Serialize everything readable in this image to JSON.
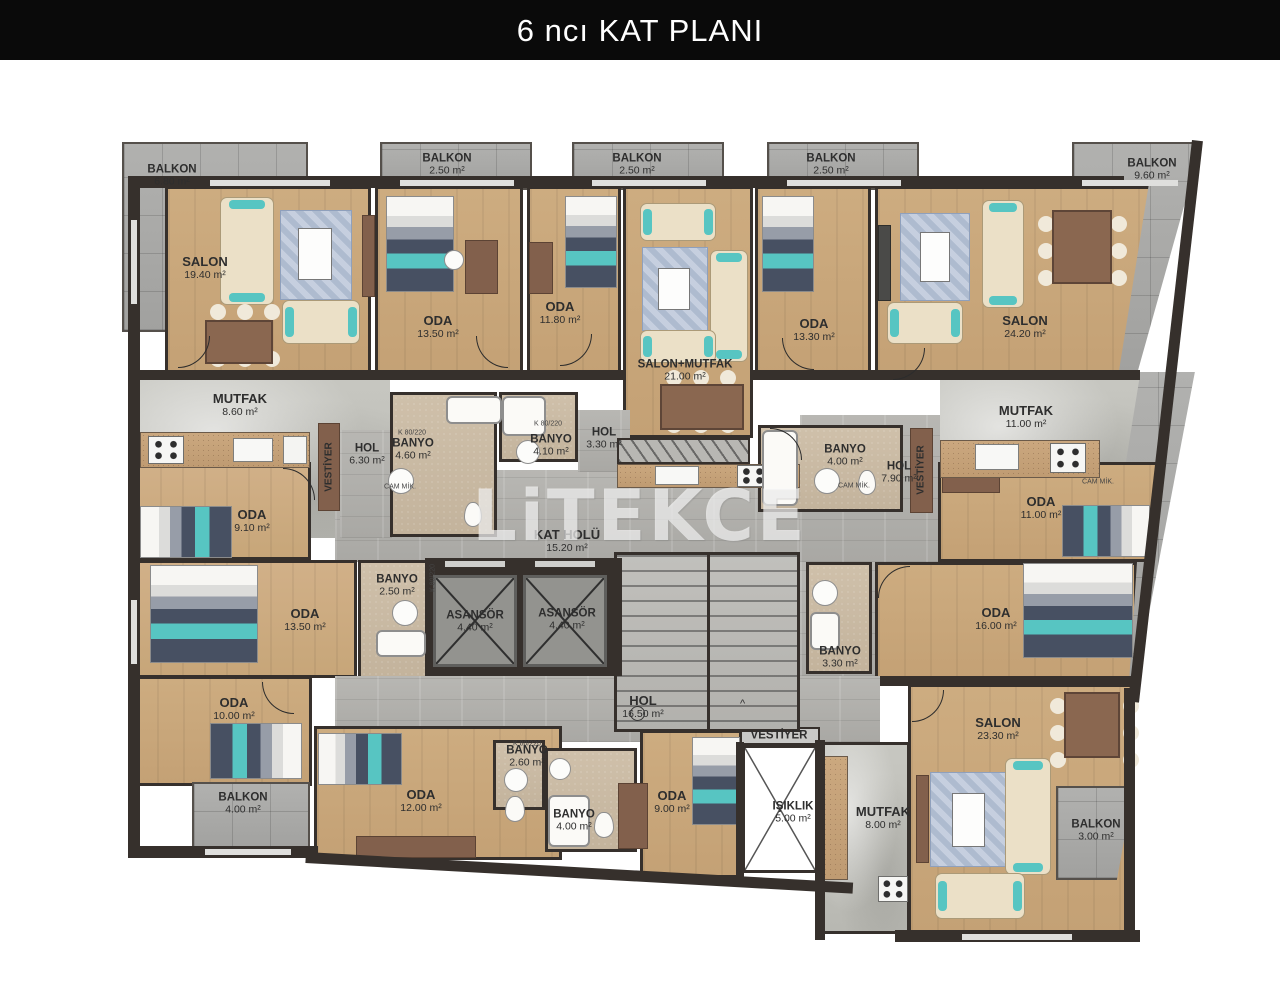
{
  "title": "6 ncı KAT PLANI",
  "watermark": "LiTEKCE",
  "tags": {
    "door": "K 80/220",
    "glass": "CAM MİK."
  },
  "colors": {
    "wall": "#36302c",
    "wood": "#c9a87c",
    "tile": "#ababa8",
    "bath": "#cdbda7",
    "teal": "#57c5c2",
    "title_bg": "#0a0a0a"
  },
  "rooms": {
    "balkon_tl": {
      "name": "BALKON",
      "area": "6.80 m²"
    },
    "balkon_t1": {
      "name": "BALKON",
      "area": "2.50 m²"
    },
    "balkon_t2": {
      "name": "BALKON",
      "area": "2.50 m²"
    },
    "balkon_t3": {
      "name": "BALKON",
      "area": "2.50 m²"
    },
    "balkon_tr": {
      "name": "BALKON",
      "area": "9.60 m²"
    },
    "salon_tl": {
      "name": "SALON",
      "area": "19.40 m²"
    },
    "oda_t1": {
      "name": "ODA",
      "area": "13.50 m²"
    },
    "oda_t2": {
      "name": "ODA",
      "area": "11.80 m²"
    },
    "salon_mutfak": {
      "name": "SALON+MUTFAK",
      "area": "21.00 m²"
    },
    "oda_t3": {
      "name": "ODA",
      "area": "13.30 m²"
    },
    "salon_tr": {
      "name": "SALON",
      "area": "24.20 m²"
    },
    "mutfak_tl": {
      "name": "MUTFAK",
      "area": "8.60 m²"
    },
    "mutfak_tr": {
      "name": "MUTFAK",
      "area": "11.00 m²"
    },
    "hol_l": {
      "name": "HOL",
      "area": "6.30 m²"
    },
    "banyo_l1": {
      "name": "BANYO",
      "area": "4.60 m²"
    },
    "banyo_c1": {
      "name": "BANYO",
      "area": "4.10 m²"
    },
    "hol_c": {
      "name": "HOL",
      "area": "3.30 m²"
    },
    "banyo_r1": {
      "name": "BANYO",
      "area": "4.00 m²"
    },
    "hol_r": {
      "name": "HOL",
      "area": "7.90 m²"
    },
    "oda_l1": {
      "name": "ODA",
      "area": "9.10 m²"
    },
    "oda_l2": {
      "name": "ODA",
      "area": "13.50 m²"
    },
    "banyo_l2": {
      "name": "BANYO",
      "area": "2.50 m²"
    },
    "kat_holu": {
      "name": "KAT HOLÜ",
      "area": "15.20 m²"
    },
    "asansor1": {
      "name": "ASANSÖR",
      "area": "4.40 m²"
    },
    "asansor2": {
      "name": "ASANSÖR",
      "area": "4.40 m²"
    },
    "oda_r1": {
      "name": "ODA",
      "area": "11.00 m²"
    },
    "oda_r2": {
      "name": "ODA",
      "area": "16.00 m²"
    },
    "banyo_r2": {
      "name": "BANYO",
      "area": "3.30 m²"
    },
    "oda_b1": {
      "name": "ODA",
      "area": "10.00 m²"
    },
    "balkon_bl": {
      "name": "BALKON",
      "area": "4.00 m²"
    },
    "oda_b2": {
      "name": "ODA",
      "area": "12.00 m²"
    },
    "banyo_b1": {
      "name": "BANYO",
      "area": "2.60 m²"
    },
    "banyo_b2": {
      "name": "BANYO",
      "area": "4.00 m²"
    },
    "hol_b": {
      "name": "HOL",
      "area": "16.50 m²"
    },
    "oda_b3": {
      "name": "ODA",
      "area": "9.00 m²"
    },
    "isiklik": {
      "name": "IŞIKLIK",
      "area": "5.00 m²"
    },
    "vestiyer_l": {
      "name": "VESTİYER"
    },
    "vestiyer_r": {
      "name": "VESTİYER"
    },
    "vestiyer_b": {
      "name": "VESTİYER"
    },
    "mutfak_b": {
      "name": "MUTFAK",
      "area": "8.00 m²"
    },
    "salon_br": {
      "name": "SALON",
      "area": "23.30 m²"
    },
    "balkon_br": {
      "name": "BALKON",
      "area": "3.00 m²"
    }
  }
}
